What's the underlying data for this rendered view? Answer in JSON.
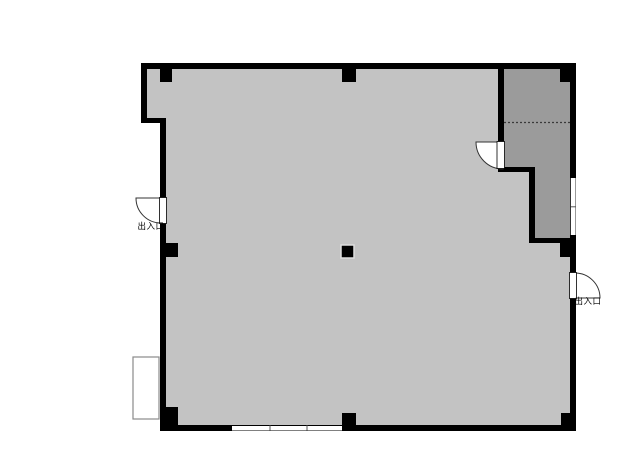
{
  "floor_plan": {
    "type": "floor-plan",
    "colors": {
      "background": "#ffffff",
      "wall": "#000000",
      "main_room_fill": "#c3c3c3",
      "storage_room_fill": "#9b9b9b",
      "window_fill": "#ffffff",
      "fixture_outline": "#8a8a8a",
      "partition_dash": "#3a3a3a"
    },
    "labels": {
      "left_entrance": "出入口",
      "right_entrance": "出入口"
    },
    "rooms": [
      {
        "id": "main-room",
        "note": "large open light-gray room"
      },
      {
        "id": "storage-room",
        "note": "darker L-shaped room, top right, with dashed partition line and door to main room"
      }
    ],
    "doors": [
      {
        "id": "left-entrance-door",
        "label": "出入口",
        "swing": "outward-left"
      },
      {
        "id": "right-entrance-door",
        "label": "出入口",
        "swing": "outward-right"
      },
      {
        "id": "storage-room-door",
        "label": "",
        "swing": "into-main-room"
      }
    ],
    "column_count": 8,
    "window_count": 2
  }
}
